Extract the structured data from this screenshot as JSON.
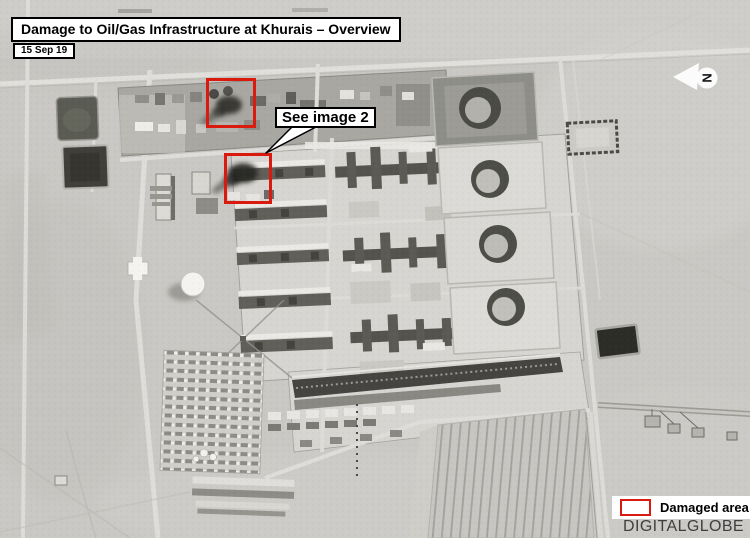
{
  "header": {
    "title": "Damage to Oil/Gas Infrastructure at Khurais – Overview",
    "date": "15 Sep 19"
  },
  "callout": {
    "label": "See image 2"
  },
  "north_indicator": {
    "label": "N"
  },
  "legend": {
    "label": "Damaged area"
  },
  "watermark": {
    "label": "DIGITALGLOBE"
  },
  "colors": {
    "damage_red": "#da1a0f",
    "watermark_gray": "#3f3f3f"
  }
}
